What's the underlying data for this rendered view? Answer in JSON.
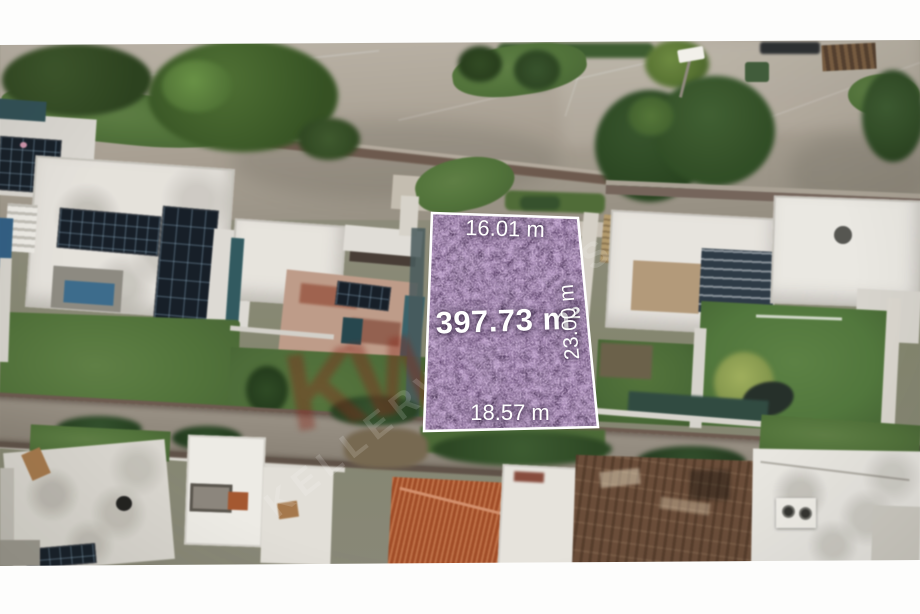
{
  "lot_overlay": {
    "area_label": "397.73 m²",
    "front_label": "16.01 m",
    "side_label": "23.00 m",
    "back_label": "18.57 m",
    "fill_color": "#5a3d69",
    "border_color": "#ffffff",
    "label_color": "#ffffff"
  },
  "watermark": {
    "brand_text": "KELLERWILLIAMS",
    "logo_text": "KW",
    "logo_color": "#8a2418"
  }
}
